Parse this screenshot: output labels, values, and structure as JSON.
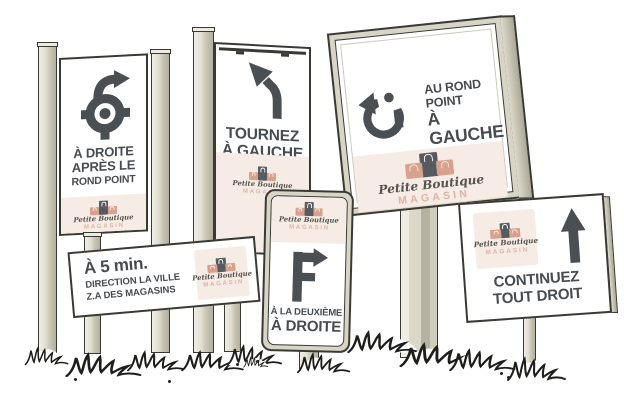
{
  "logo": {
    "name": "Petite Boutique",
    "subtitle": "MAGASIN"
  },
  "signs": {
    "roundabout_right": {
      "icon": "roundabout-exit-right-icon",
      "lines": [
        "À DROITE",
        "APRÈS LE",
        "ROND POINT"
      ]
    },
    "turn_left": {
      "icon": "turn-left-icon",
      "lines": [
        "TOURNEZ",
        "À GAUCHE"
      ]
    },
    "roundabout_left": {
      "icon": "roundabout-exit-left-icon",
      "lines": [
        "AU ROND POINT",
        "À GAUCHE"
      ]
    },
    "five_min": {
      "lines": [
        "À 5 min.",
        "DIRECTION LA VILLE",
        "Z.A DES MAGASINS"
      ]
    },
    "second_right": {
      "icon": "second-exit-right-icon",
      "lines": [
        "À LA DEUXIÈME",
        "À DROITE"
      ]
    },
    "straight": {
      "icon": "straight-ahead-icon",
      "lines": [
        "CONTINUEZ",
        "TOUT DROIT"
      ]
    }
  },
  "colors": {
    "ink": "#474c50",
    "outline": "#3a3a35",
    "post": "#ddd9ca",
    "post_shadow": "#b2af9e",
    "pink_band": "#f7ebe5",
    "bag_pink": "#d8a18e",
    "bag_dark": "#565b60",
    "magasin_pink": "#ddb3a3",
    "background": "#ffffff"
  }
}
